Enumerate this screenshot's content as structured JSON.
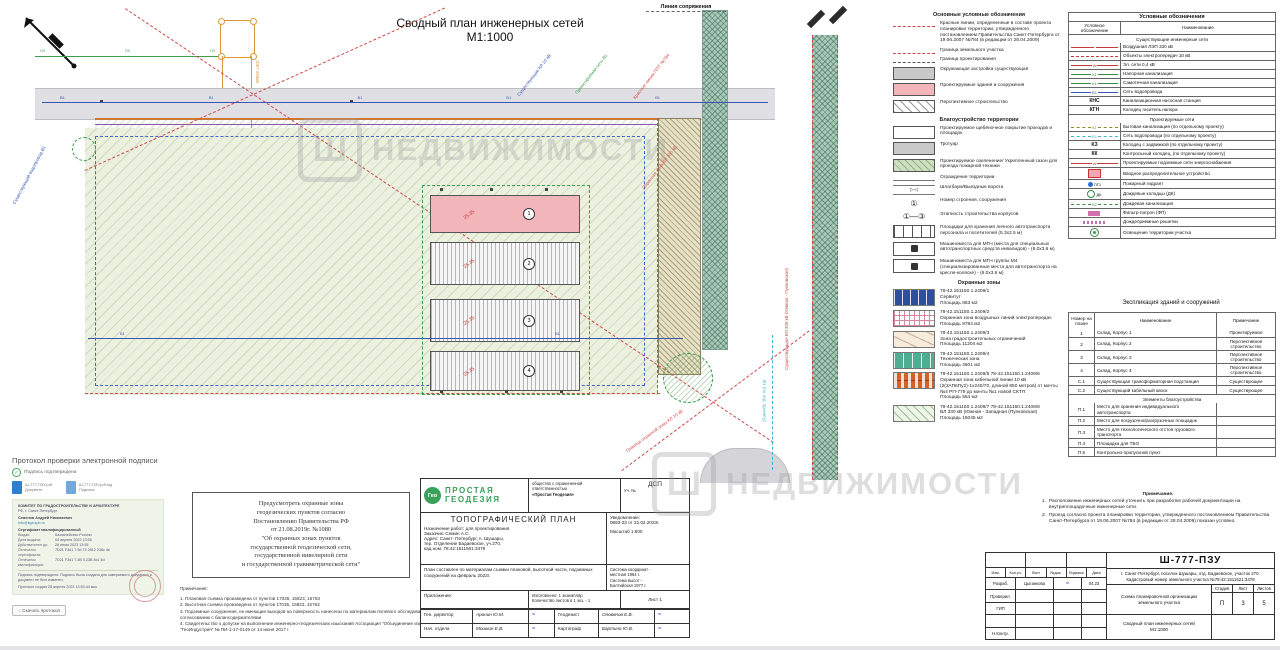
{
  "title": {
    "line1": "Сводный план инженерных сетей",
    "line2": "М1:1000"
  },
  "watermark": {
    "logo": "Ш",
    "text": "НЕДВИЖИМОСТИ"
  },
  "plan": {
    "conn": "Линия сопряжения",
    "lep": "ЛЭП 330кВ",
    "v1_labels": [
      "В1",
      "В1",
      "В1",
      "В1",
      "В1"
    ],
    "lz_labels": [
      "ЛЗ",
      "ЛЗ",
      "ЛЗ"
    ],
    "mid_labels": [
      "В1",
      "В1"
    ],
    "buildings": [
      {
        "sw": "bb pink",
        "num": "1",
        "elev": "25.35"
      },
      {
        "sw": "bb hat",
        "num": "2",
        "elev": "25.35"
      },
      {
        "sw": "bb hat",
        "num": "3",
        "elev": "25.35"
      },
      {
        "sw": "bb hat",
        "num": "4",
        "elev": "25.35"
      }
    ],
    "callouts": {
      "blue1": "Существующие КЛ 10 кВ",
      "green1": "Проектируемая сеть В1",
      "red1": "Красные линии ППТ №784",
      "red2": "Охранная зона ВЛ 330 кВ",
      "blue2": "Существующий водопровод В1",
      "red3": "Граница охранной зоны КЛ 10 кВ",
      "redv": "Существующая ВЛ 330 кВ (Южная - Пулковская)",
      "cynv": "В1 (по отд. проекту)"
    }
  },
  "legend": {
    "title": "Основные условные обозначения",
    "items1": [
      {
        "sw": "sw ln",
        "label": "Красные линии, определенные в составе проекта планировки территории, утвержденного постановлением Правительства Санкт-Петербурга от 19.06.2007 №784 (в редакции от 28.04.2009)"
      },
      {
        "sw": "sw ln",
        "label": "Граница земельного участка"
      },
      {
        "sw": "sw ln dd",
        "label": "Граница проектирования"
      },
      {
        "sw": "sw bx gray",
        "label": "Окружающая застройка существующая"
      },
      {
        "sw": "sw bx pink",
        "label": "Проектируемые здания и сооружения"
      },
      {
        "sw": "sw bx persp",
        "label": "Перспективное строительство"
      }
    ],
    "subtitle2": "Благоустройство территории",
    "items2": [
      {
        "sw": "sw bx",
        "glyph": "",
        "label": "Проектируемое щебёночное покрытие проездов и площадок"
      },
      {
        "sw": "sw bx gray",
        "glyph": "",
        "label": "Тротуар"
      },
      {
        "sw": "sw bx grn",
        "glyph": "",
        "label": "Проектируемое озеленение/ Укрепленный газон для проезда пожарной техники"
      },
      {
        "sw": "sw fence",
        "glyph": "",
        "label": "Ограждение территории"
      },
      {
        "sw": "sw gate",
        "glyph": "▷◁",
        "label": "Шлагбаум/Выездные ворота"
      },
      {
        "sw": "sw cnum",
        "glyph": "①",
        "label": "Номер строения, сооружения"
      },
      {
        "sw": "sw cnum",
        "glyph": "①—③",
        "label": "Этапность строительства корпусов"
      },
      {
        "sw": "sw park",
        "glyph": "",
        "label": "Площадки для хранения личного автотранспорта персонала и посетителей (5.3х2.5 м)"
      },
      {
        "sw": "sw mgn",
        "glyph": "",
        "label": "Машиноместа для МГН (места для специальных автотранспортных средств инвалидов) - (6.0х3.6 м)"
      },
      {
        "sw": "sw mgn",
        "glyph": "",
        "label": "Машиноместа для МГН группы М4 (специализированные места для автотранспорта на кресле-коляске) - (6.0х3.6 м)"
      }
    ],
    "subtitle3": "Охранные зоны",
    "zones": [
      {
        "sw": "sw z z1",
        "code": "78-42.151150.1.2409/1",
        "name": "Сервитут",
        "area": "Площадь 863 м2"
      },
      {
        "sw": "sw z z2",
        "code": "78-42.151150.1.2409/2",
        "name": "Охранная зона воздушных линий электропередач",
        "area": "Площадь 8784 м2"
      },
      {
        "sw": "sw z z3",
        "code": "78-42.151150.1.2409/3",
        "name": "Зона градостроительных ограничений",
        "area": "Площадь 11204 м2"
      },
      {
        "sw": "sw z z4",
        "code": "78-42.151150.1.2409/4",
        "name": "Техническая зона",
        "area": "Площадь 4601 м2"
      },
      {
        "sw": "sw z z5",
        "code": "78-42.151150.1.2409/5  78-42.151150.1.2409/6",
        "name": "Охранная зона кабельной линии 10 кВ (2(3АПвПу2)-1х240/70, длиной 850 метров) от мачты №4 РП-779 до мачты №1 новой СКТП",
        "area": "Площадь 554 м2"
      },
      {
        "sw": "sw z z6",
        "code": "78-42.151150.1.2409/7  78-42.151150.1.2409/8",
        "name": "ВЛ 330 кВ (Южная - Западная (Пулковская)",
        "area": "Площадь 16045 м2"
      }
    ]
  },
  "symbols": {
    "title": "Условные обозначения",
    "col1": "Условное обозначение",
    "col2": "Наименование",
    "sec1": "Существующие инженерные сети",
    "rows1": [
      {
        "sw": "cell cs lin red",
        "t": "",
        "n": "Воздушная ЛЭП 330 кВ"
      },
      {
        "sw": "cell cs lin dsh red",
        "t": "",
        "n": "Объекты электропередач 10 кВ"
      },
      {
        "sw": "cell cs lin red",
        "t": "W",
        "n": "Эл. сети 0,4 кВ"
      },
      {
        "sw": "cell cs lin grn",
        "t": "К1",
        "n": "Напорная канализация"
      },
      {
        "sw": "cell cs lin grn",
        "t": "К1",
        "n": "Самотечная канализация"
      },
      {
        "sw": "cell cs lin blu",
        "t": "В1",
        "n": "Сеть водопровода"
      },
      {
        "sw": "cell cs txt",
        "t": "КНС",
        "n": "Канализационная насосная станция"
      },
      {
        "sw": "cell cs txt",
        "t": "КГН",
        "n": "Колодец гаситель напора"
      }
    ],
    "sec2": "Проектируемые сети",
    "rows2": [
      {
        "sw": "cell cs lin dsh olv",
        "t": "К1",
        "n": "Бытовая канализация (по отдельному проекту)"
      },
      {
        "sw": "cell cs lin dsh cyn",
        "t": "В1",
        "n": "Сеть водопровода (по отдельному проекту)"
      },
      {
        "sw": "cell cs txt",
        "t": "КЗ",
        "n": "Колодец с задвижкой (по отдельному проекту)"
      },
      {
        "sw": "cell cs txt",
        "t": "КК",
        "n": "Контрольный колодец, (по отдельному проекту)"
      },
      {
        "sw": "cell cs lin red",
        "t": "W",
        "n": "Проектируемые подземные сети энергоснабжения"
      },
      {
        "sw": "cell cs ic i-vru",
        "t": "",
        "n": "Вводное распределительное устройство"
      },
      {
        "sw": "cell cs ic i-pg",
        "t": "ПГ1",
        "n": "Пожарный гидрант"
      },
      {
        "sw": "cell cs ic i-dk",
        "t": "ДК",
        "n": "Дождевые колодцы (ДК)"
      },
      {
        "sw": "cell cs lin dsh grn",
        "t": "К2",
        "n": "Дождевая канализация"
      },
      {
        "sw": "cell cs ic i-fp",
        "t": "",
        "n": "Фильтр-патрон (ФП)"
      },
      {
        "sw": "cell cs ic i-resh",
        "t": "",
        "n": "Дождеприемные решетки"
      },
      {
        "sw": "cell cs ic i-osv",
        "t": "",
        "n": "Освещение территории участка"
      }
    ]
  },
  "explication": {
    "title": "Экспликация зданий и сооружений",
    "col_num": "Номер на плане",
    "col_name": "Наименование",
    "col_note": "Примечание",
    "rows1": [
      {
        "num": "1",
        "name": "Склад, Корпус 1",
        "note": "Проектируемое"
      },
      {
        "num": "2",
        "name": "Склад, Корпус 2",
        "note": "Перспективное строительство"
      },
      {
        "num": "3",
        "name": "Склад, Корпус 3",
        "note": "Перспективное строительство"
      },
      {
        "num": "4",
        "name": "Склад, Корпус 4",
        "note": "Перспективное строительство"
      },
      {
        "num": "С.1",
        "name": "Существующая трансформаторная подстанция",
        "note": "Существующее"
      },
      {
        "num": "С.2",
        "name": "Существующий кабельный киоск",
        "note": "Существующее"
      }
    ],
    "section": "Элементы благоустройства",
    "rows2": [
      {
        "num": "П.1",
        "name": "Место для хранения индивидуального автотранспорта",
        "note": ""
      },
      {
        "num": "П.2",
        "name": "Место для погрузочно/разгрузочных площадок",
        "note": ""
      },
      {
        "num": "П.3",
        "name": "Место для технологического отстоя грузового транспорта",
        "note": ""
      },
      {
        "num": "П.4",
        "name": "Площадка для ТБО",
        "note": ""
      },
      {
        "num": "П.5",
        "name": "Контрольно-пропускной пункт",
        "note": ""
      }
    ]
  },
  "notes_right": {
    "heading": "Примечание.",
    "n1num": "1.",
    "n1": "Расположение инженерных сетей уточнить при разработке рабочей документации на внутриплощадочные инженерные сети.",
    "n2num": "2.",
    "n2": "Проезд согласно проекта планировки территории, утвержденного постановлением Правительства Санкт-Петербурга от 19.06.2007 №784 (в редакции от 28.04.2009) показан условно."
  },
  "geo_box": {
    "text": "Предусмотреть охранные зоны\nгеодезических пунктов согласно\nПостановлению Правительства РФ\nот 21.08.2019г. №1080\n\"Об охранных зонах пунктов\nгосударственной геодезической сети,\nгосударственной нивелирной сети\nи государственной гравиметрической сети\""
  },
  "survey_notes": {
    "heading": "Примечания:",
    "l1": "1. Плановая съемка произведена от пунктов 17035, 15823, 15763",
    "l2": "2. Высотная съемка произведена от пунктов 17035, 15823, 15763",
    "l3": "3. Подземные  сооружения, не имеющие  выходов на поверхность нанесены по материалам полевого обследования и согласованию с балансодержателями",
    "l4": "4. Свидетельство о допуске на выполнение инженерно-геодезических изысканий Ассоциация \"Объединение изыскателей \"ГеоИндустрия\" № ПИ-1-17-0149 от 14 июня 2017 г."
  },
  "stamp": {
    "logo_badge": "Гео",
    "logo1": "ПРОСТАЯ",
    "logo2": "ГЕОДЕЗИЯ",
    "org1": "общество с ограниченной ответственностью",
    "org2": "«Простая Геодезия»",
    "dsp": "ДСП",
    "uch": "Уч. №",
    "plan_title": "ТОПОГРАФИЧЕСКИЙ ПЛАН",
    "purpose": "Назначение работ: для проектирования",
    "customer": "Заказчик: Семин А.С",
    "address": "Адрес: Санкт- Петербург, п. Шушары,\nтер. Отделение Бадаевское, уч.270,\nкад.ном. 78:42:1511501:3478",
    "notice": "Уведомление:\n0893-23  от 22.02.2023г.",
    "scale": "Масштаб 1:500",
    "composed": "План составлен по материалам съемки плановой, высотной части, подземных сооружений на февраль 2023г.",
    "coords": "Система координат -\nместная 1964 г.\nСистема высот -\nБалтийская 1977 г.",
    "attachment": "Приложение:",
    "made": "Изготовлено: 1 экземпляр\nКоличество листов в 1 экз. - 1",
    "sheet": "Лист 1",
    "signs": [
      {
        "a": "Ген. директор",
        "b": "Аронин Ю.М.",
        "s1": "≈",
        "c": "Геодезист",
        "d": "Оловянов Е.В.",
        "s2": "≈"
      },
      {
        "a": "Нач. отдела",
        "b": "Мошкин Е.В.",
        "s1": "≈",
        "c": "Картограф",
        "d": "Бартина Ю.В.",
        "s2": "≈"
      }
    ]
  },
  "titleblock": {
    "code": "Ш-777-ПЗУ",
    "address": "г. Санкт-Петербург, поселок Шушары, отд. Бадаевское, участок 270.\nКадастровый номер земельного участка №78:42:1511521:3478",
    "cols": [
      "Изм.",
      "Кол.уч.",
      "Лист",
      "№док.",
      "Подпись",
      "Дата"
    ],
    "rows": [
      {
        "role": "Разраб.",
        "name": "Цыганкова",
        "sig": "≈",
        "date": "04.23"
      },
      {
        "role": "Проверил.",
        "name": "",
        "sig": "",
        "date": ""
      },
      {
        "role": "ГИП",
        "name": "",
        "sig": "",
        "date": ""
      },
      {
        "role": "",
        "name": "",
        "sig": "",
        "date": ""
      },
      {
        "role": "Н.Контр.",
        "name": "",
        "sig": "",
        "date": ""
      }
    ],
    "doc1": "Схема планировочной организации\nземельного участка",
    "stage_label": "Стадия",
    "sheet_label": "Лист",
    "sheets_label": "Листов",
    "stage": "П",
    "sheet": "3",
    "sheets": "5",
    "doc2": "Сводный план инженерных сетей\nМ1:1000"
  },
  "esign": {
    "title": "Протокол проверки электронной подписи",
    "verified": "Подпись подтверждена",
    "file1_name": "Ш-777-ПЗУ.pdf",
    "file1_sub": "Документ",
    "file2_name": "Ш-777-ПЗУ.pdf.sig",
    "file2_sub": "Подпись",
    "cert": {
      "org": "КОМИТЕТ ПО ГРАДОСТРОИТЕЛЬСТВУ И АРХИТЕКТУРЕ",
      "loc": "РФ, г. Санкт-Петербург",
      "name": "Семенов Андрей Николаевич",
      "email": "info@kga.spb.ru",
      "type": "Сертификат квалифицированный",
      "fields": [
        {
          "k": "Выдан:",
          "v": "Казначейство России"
        },
        {
          "k": "Дата выдачи:",
          "v": "04 апреля 2022 13:55"
        },
        {
          "k": "Действителен до:",
          "v": "28 июня 2023 13:55"
        },
        {
          "k": "Отпечаток сертификата:",
          "v": "7D21 F3d1 7.5d 73 2812 238c 4e"
        },
        {
          "k": "Отпечаток квалификации:",
          "v": "7D21 F3d1 7.4B 0.23B 8c1 4d"
        }
      ],
      "note": "Подпись подтверждена. Подпись была создана для заверяемого документа и документ не был изменен.",
      "created": "Протокол создан 28 апреля 2023 13:53:44 мск"
    },
    "download": "Скачать протокол",
    "download_icon": "↓"
  }
}
